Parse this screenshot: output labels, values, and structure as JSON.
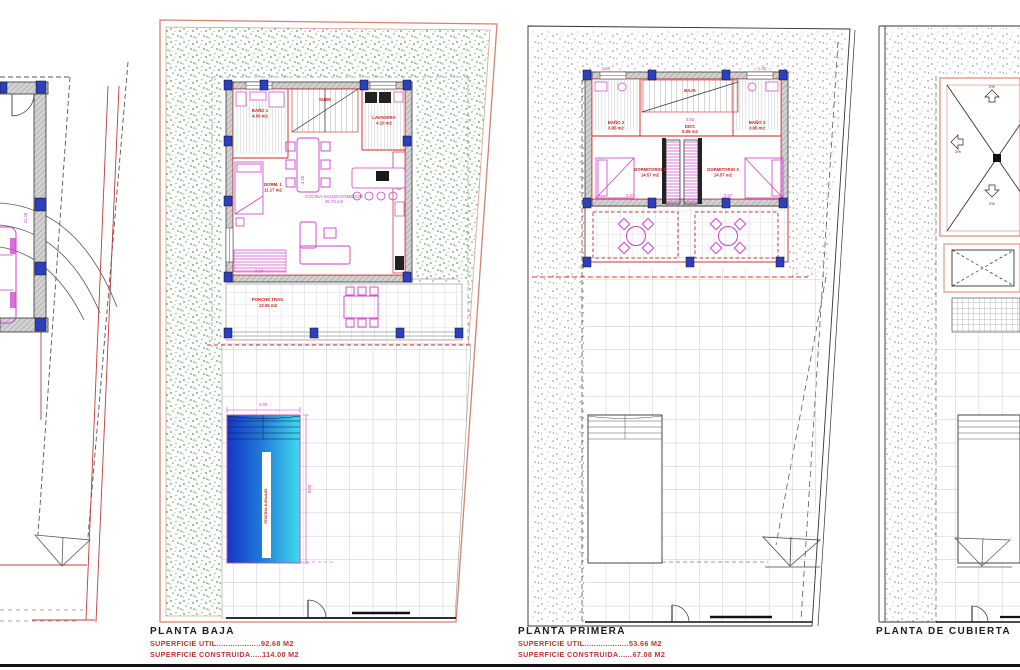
{
  "colors": {
    "garden_green": "#5aa85a",
    "plot_pink": "#d4836f",
    "wall_red": "#cc2222",
    "furniture_magenta": "#cc3fcc",
    "column_blue": "#2c3fbe",
    "pool_dark": "#1635c5",
    "pool_light": "#41d9ef",
    "label_red": "#c23434"
  },
  "plans": {
    "left_partial": {
      "dim_side": "11.45"
    },
    "baja": {
      "title": "PLANTA BAJA",
      "superficie_util": "SUPERFICIE UTIL...................92.68 M2",
      "superficie_construida": "SUPERFICIE CONSTRUIDA.....114.00 M2",
      "rooms": {
        "bano1": "BAÑO 1",
        "bano1_area": "4.00 m2",
        "dorm1": "DORM. 1",
        "dorm1_area": "11.17 m2",
        "lavadero": "LAVADERO",
        "lavadero_area": "4.10 m2",
        "salon": "COCINA-SALON-COMEDOR",
        "salon_area": "45.74 m2",
        "porche": "PORCHE TRAS.",
        "porche_area": "13.05 m2",
        "stairs": "SUBE",
        "piscina": "PISCINA 8.00x4.00"
      },
      "dims": {
        "pool_w": "4.00",
        "pool_h": "8.00",
        "porche_w": "10.74",
        "room_w": "3.20",
        "salon_h": "4.20"
      }
    },
    "primera": {
      "title": "PLANTA PRIMERA",
      "superficie_util": "SUPERFICIE UTIL...................53.66 M2",
      "superficie_construida": "SUPERFICIE CONSTRUIDA......67.08 M2",
      "rooms": {
        "bano2": "BAÑO 2",
        "bano2_area": "3.95 m2",
        "bano3": "BAÑO 3",
        "bano3_area": "3.95 m2",
        "dorm2": "DORMITORIO 2",
        "dorm2_area": "14.57 m2",
        "dorm3": "DORMITORIO 3",
        "dorm3_area": "14.57 m2",
        "dist": "DIST.",
        "dist_area": "5.06 m2",
        "stairs": "BAJA"
      },
      "dims": {
        "bed_left": "2.87",
        "bed_right": "2.87",
        "top_left": "1.40",
        "top_right": "1.60",
        "hall": "3.50"
      }
    },
    "cubierta": {
      "title": "PLANTA DE CUBIERTA",
      "slope_top": "2%",
      "slope_left": "2%",
      "slope_bottom": "2%"
    }
  }
}
